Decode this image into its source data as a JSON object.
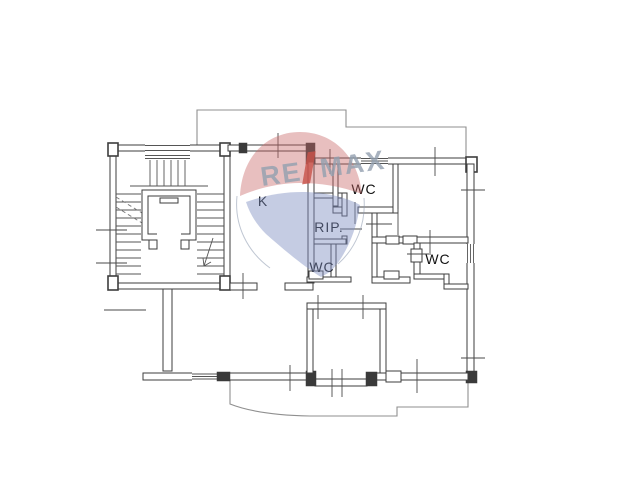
{
  "floor_plan": {
    "room_labels": {
      "kitchen": "K",
      "wc_top": "WC",
      "storage": "RIP.",
      "wc_bottom": "WC",
      "wc_right": "WC"
    }
  },
  "watermark": {
    "brand_re": "RE",
    "brand_slash": "/",
    "brand_max": "MAX",
    "colors": {
      "balloon_top_red": "#c96666",
      "balloon_bottom_blue": "#7f8fc0",
      "wordmark_gray": "#93a0b0",
      "slash_red": "#c8534a"
    }
  },
  "canvas": {
    "background": "#ffffff",
    "wall_line_color": "#3d3d3d",
    "outline_color": "#8f8f8f"
  }
}
